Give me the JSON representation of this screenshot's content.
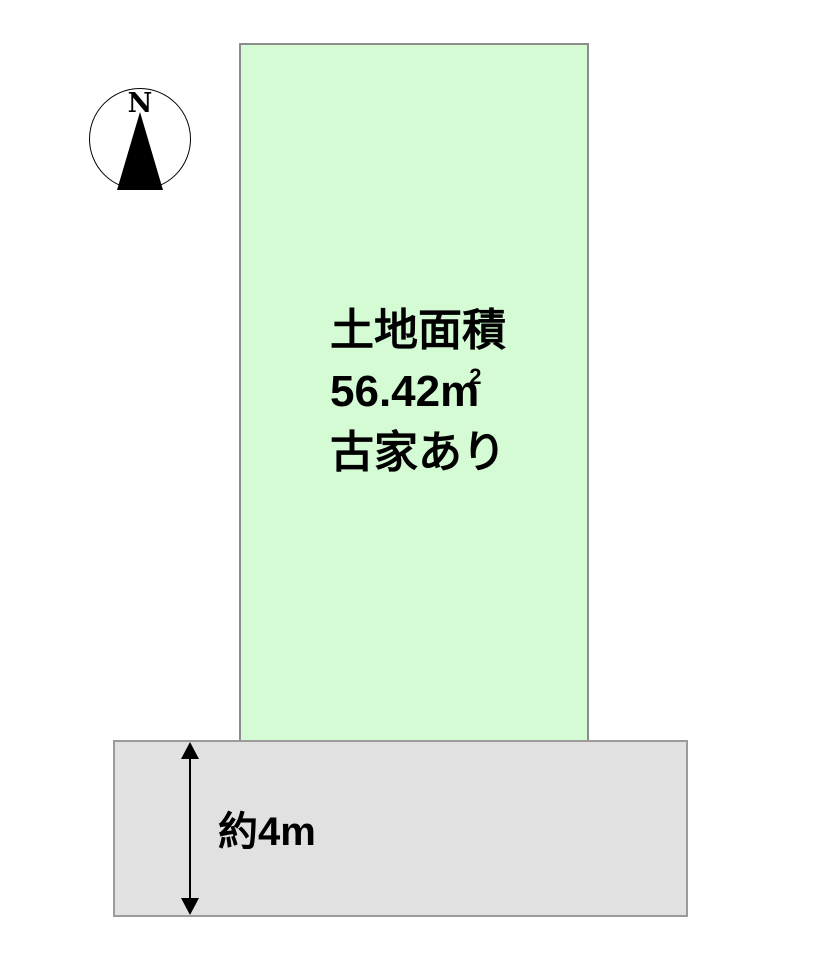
{
  "compass": {
    "north_label": "N"
  },
  "parcel": {
    "area_label": "土地面積",
    "area_value": "56.42",
    "area_unit": "m",
    "area_unit_exponent": "2",
    "note": "古家あり",
    "fill_color": "#d5fbd5",
    "border_color": "#8c8c8c"
  },
  "road": {
    "width_label": "約4m",
    "fill_color": "#e1e1e1",
    "border_color": "#9b9b9b"
  },
  "colors": {
    "background": "#ffffff",
    "text": "#000000",
    "compass_needle": "#000000"
  }
}
